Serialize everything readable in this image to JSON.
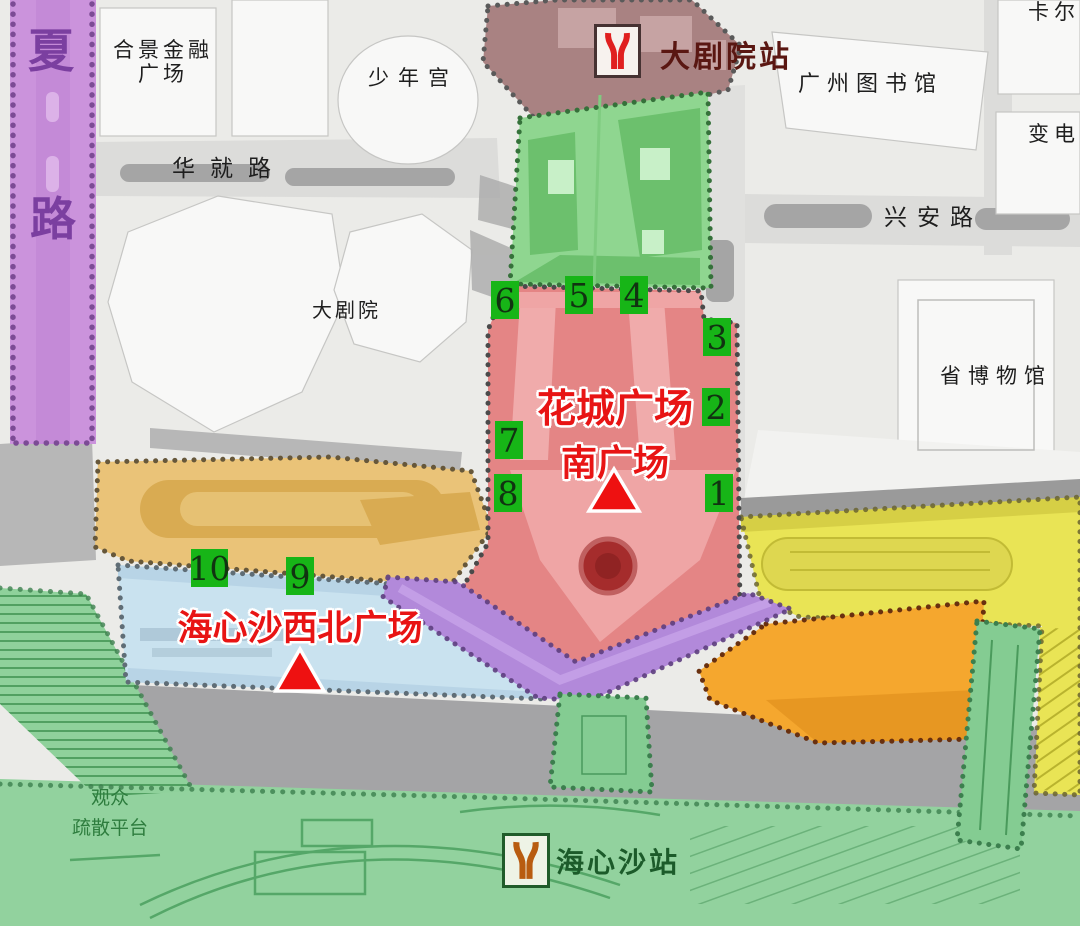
{
  "plazas": {
    "huacheng_south": {
      "line1": "花城广场",
      "line2": "南广场"
    },
    "haixinsha_nw": {
      "name": "海心沙西北广场"
    }
  },
  "stations": {
    "grand_theatre": {
      "name": "大剧院站"
    },
    "haixinsha": {
      "name": "海心沙站"
    }
  },
  "roads": {
    "huaxia_char1": "夏",
    "huaxia_char2": "路",
    "huajiu": "华就路",
    "xingan": "兴安路"
  },
  "buildings": {
    "hejing_line1": "合景金融",
    "hejing_line2": "广场",
    "youth_palace": "少年宫",
    "grand_theatre": "大剧院",
    "gz_library": "广州图书馆",
    "provincial_museum": "省博物馆",
    "karl": "卡尔",
    "substation": "变电"
  },
  "platform": {
    "line1": "观众",
    "line2": "疏散平台"
  },
  "markers": [
    "1",
    "2",
    "3",
    "4",
    "5",
    "6",
    "7",
    "8",
    "9",
    "10"
  ],
  "icons": {
    "station_logo": "guangzhou-metro-logo",
    "plaza_marker": "red-triangle"
  },
  "colors": {
    "zone_red_plaza": "#e48585",
    "zone_green_north": "#8fd690",
    "zone_brown_station": "#a98282",
    "zone_tan_strip": "#eac378",
    "zone_blue_plaza": "#c9e2ef",
    "zone_yellow": "#e9e455",
    "zone_orange": "#f5a72e",
    "zone_purple_link": "#b289da",
    "purple_road": "#cb93dc",
    "island_green": "#92d29e",
    "gray_road": "#a4a4a6",
    "marker_green": "#17b517",
    "plaza_text_red": "#e81414",
    "metro_logo_red": "#e01f1f",
    "metro_logo_brown": "#b85c10"
  }
}
